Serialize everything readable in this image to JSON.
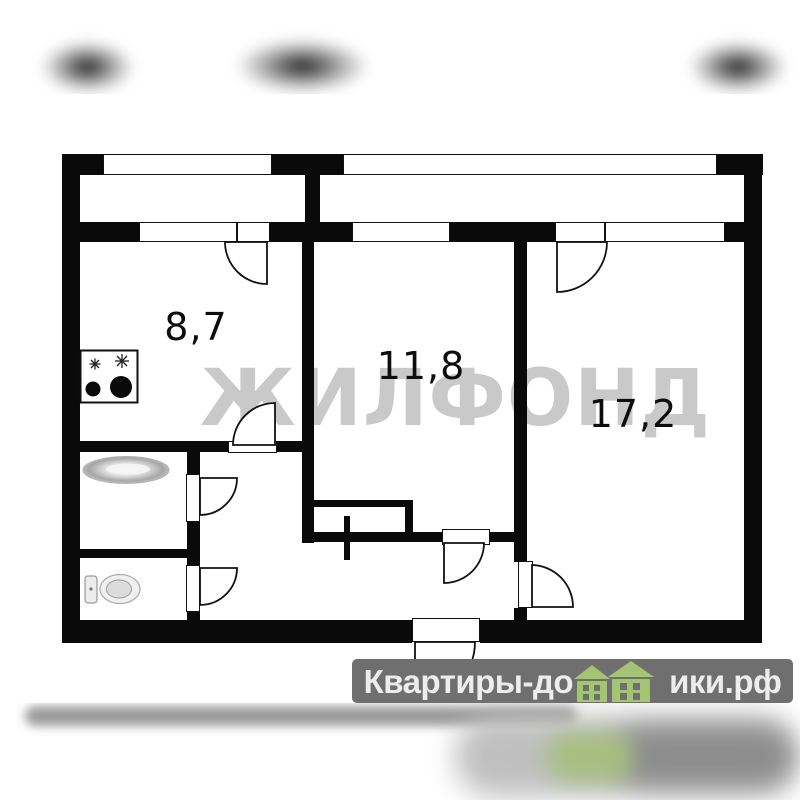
{
  "page": {
    "background": "#ffffff",
    "wall_color": "#0a0a0a"
  },
  "floor_plan": {
    "rooms": [
      {
        "name": "kitchen",
        "area_label": "8,7"
      },
      {
        "name": "room-middle",
        "area_label": "11,8"
      },
      {
        "name": "room-right",
        "area_label": "17,2"
      }
    ],
    "fixtures": [
      {
        "icon": "stove-icon"
      },
      {
        "icon": "bathtub-icon"
      },
      {
        "icon": "toilet-icon"
      },
      {
        "icon": "wardrobe-rod-icon"
      }
    ]
  },
  "watermark": {
    "text": "ЖИЛФОНД",
    "color": "#c9c9c9"
  },
  "logo_banner": {
    "text_before_houses": "Квартиры-до",
    "text_after_houses": "ики.рф",
    "full_name": "Квартиры-домики.рф",
    "background": "#6f6f6f",
    "text_color": "#ededed",
    "house_icon": "house-icon",
    "house_color": "#a3c471"
  }
}
